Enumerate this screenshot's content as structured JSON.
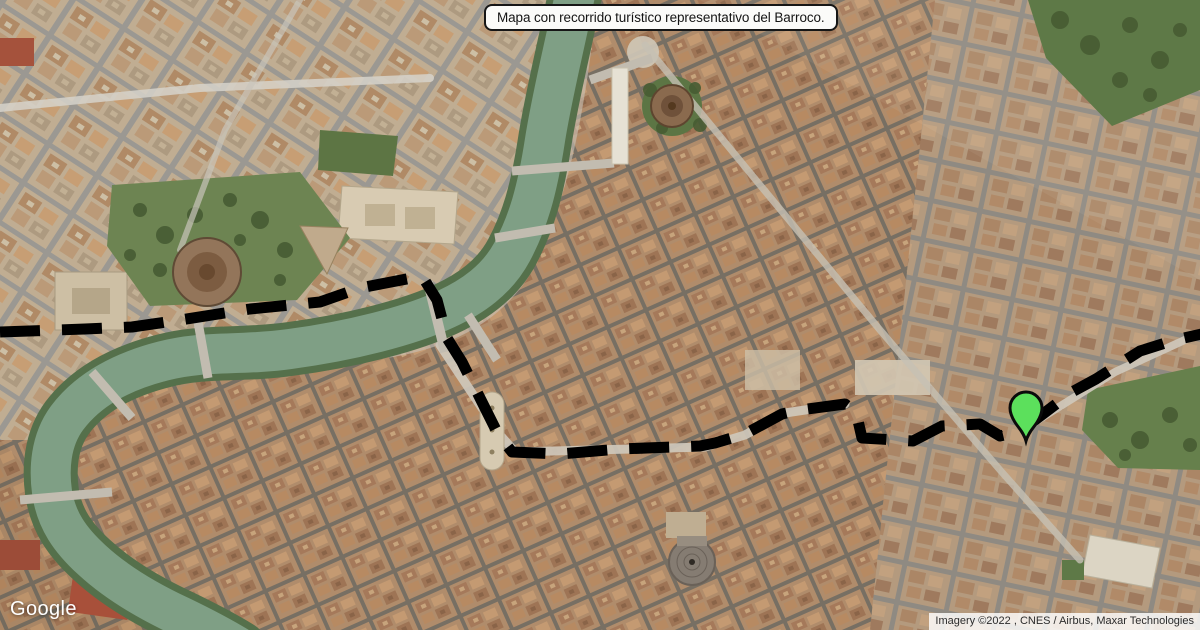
{
  "overlay": {
    "title": "Mapa con recorrido turístico representativo del Barroco."
  },
  "route": {
    "points": "0,332 85,329 132,327 180,320 250,309 320,302 360,288 422,276 437,300 447,338 462,362 480,398 498,434 512,452 560,454 620,449 700,446 715,443 745,434 782,414 800,410 845,404 856,412 862,438 913,441 942,426 980,424 1000,436 1013,433 1035,420 1072,392 1096,379 1140,351 1175,340 1206,333",
    "color": "#000000",
    "dash": "40 22",
    "width": "11"
  },
  "marker": {
    "transform": "translate(1026,441)",
    "fill": "#5ce05c",
    "outline": "#0b0b0b"
  },
  "map_colors": {
    "river": "#7f9f85",
    "river_banks": "#55704b",
    "park_green": "#6d8452"
  },
  "branding": {
    "logo_text": "Google"
  },
  "attribution": {
    "text": "Imagery ©2022 , CNES / Airbus, Maxar Technologies"
  }
}
